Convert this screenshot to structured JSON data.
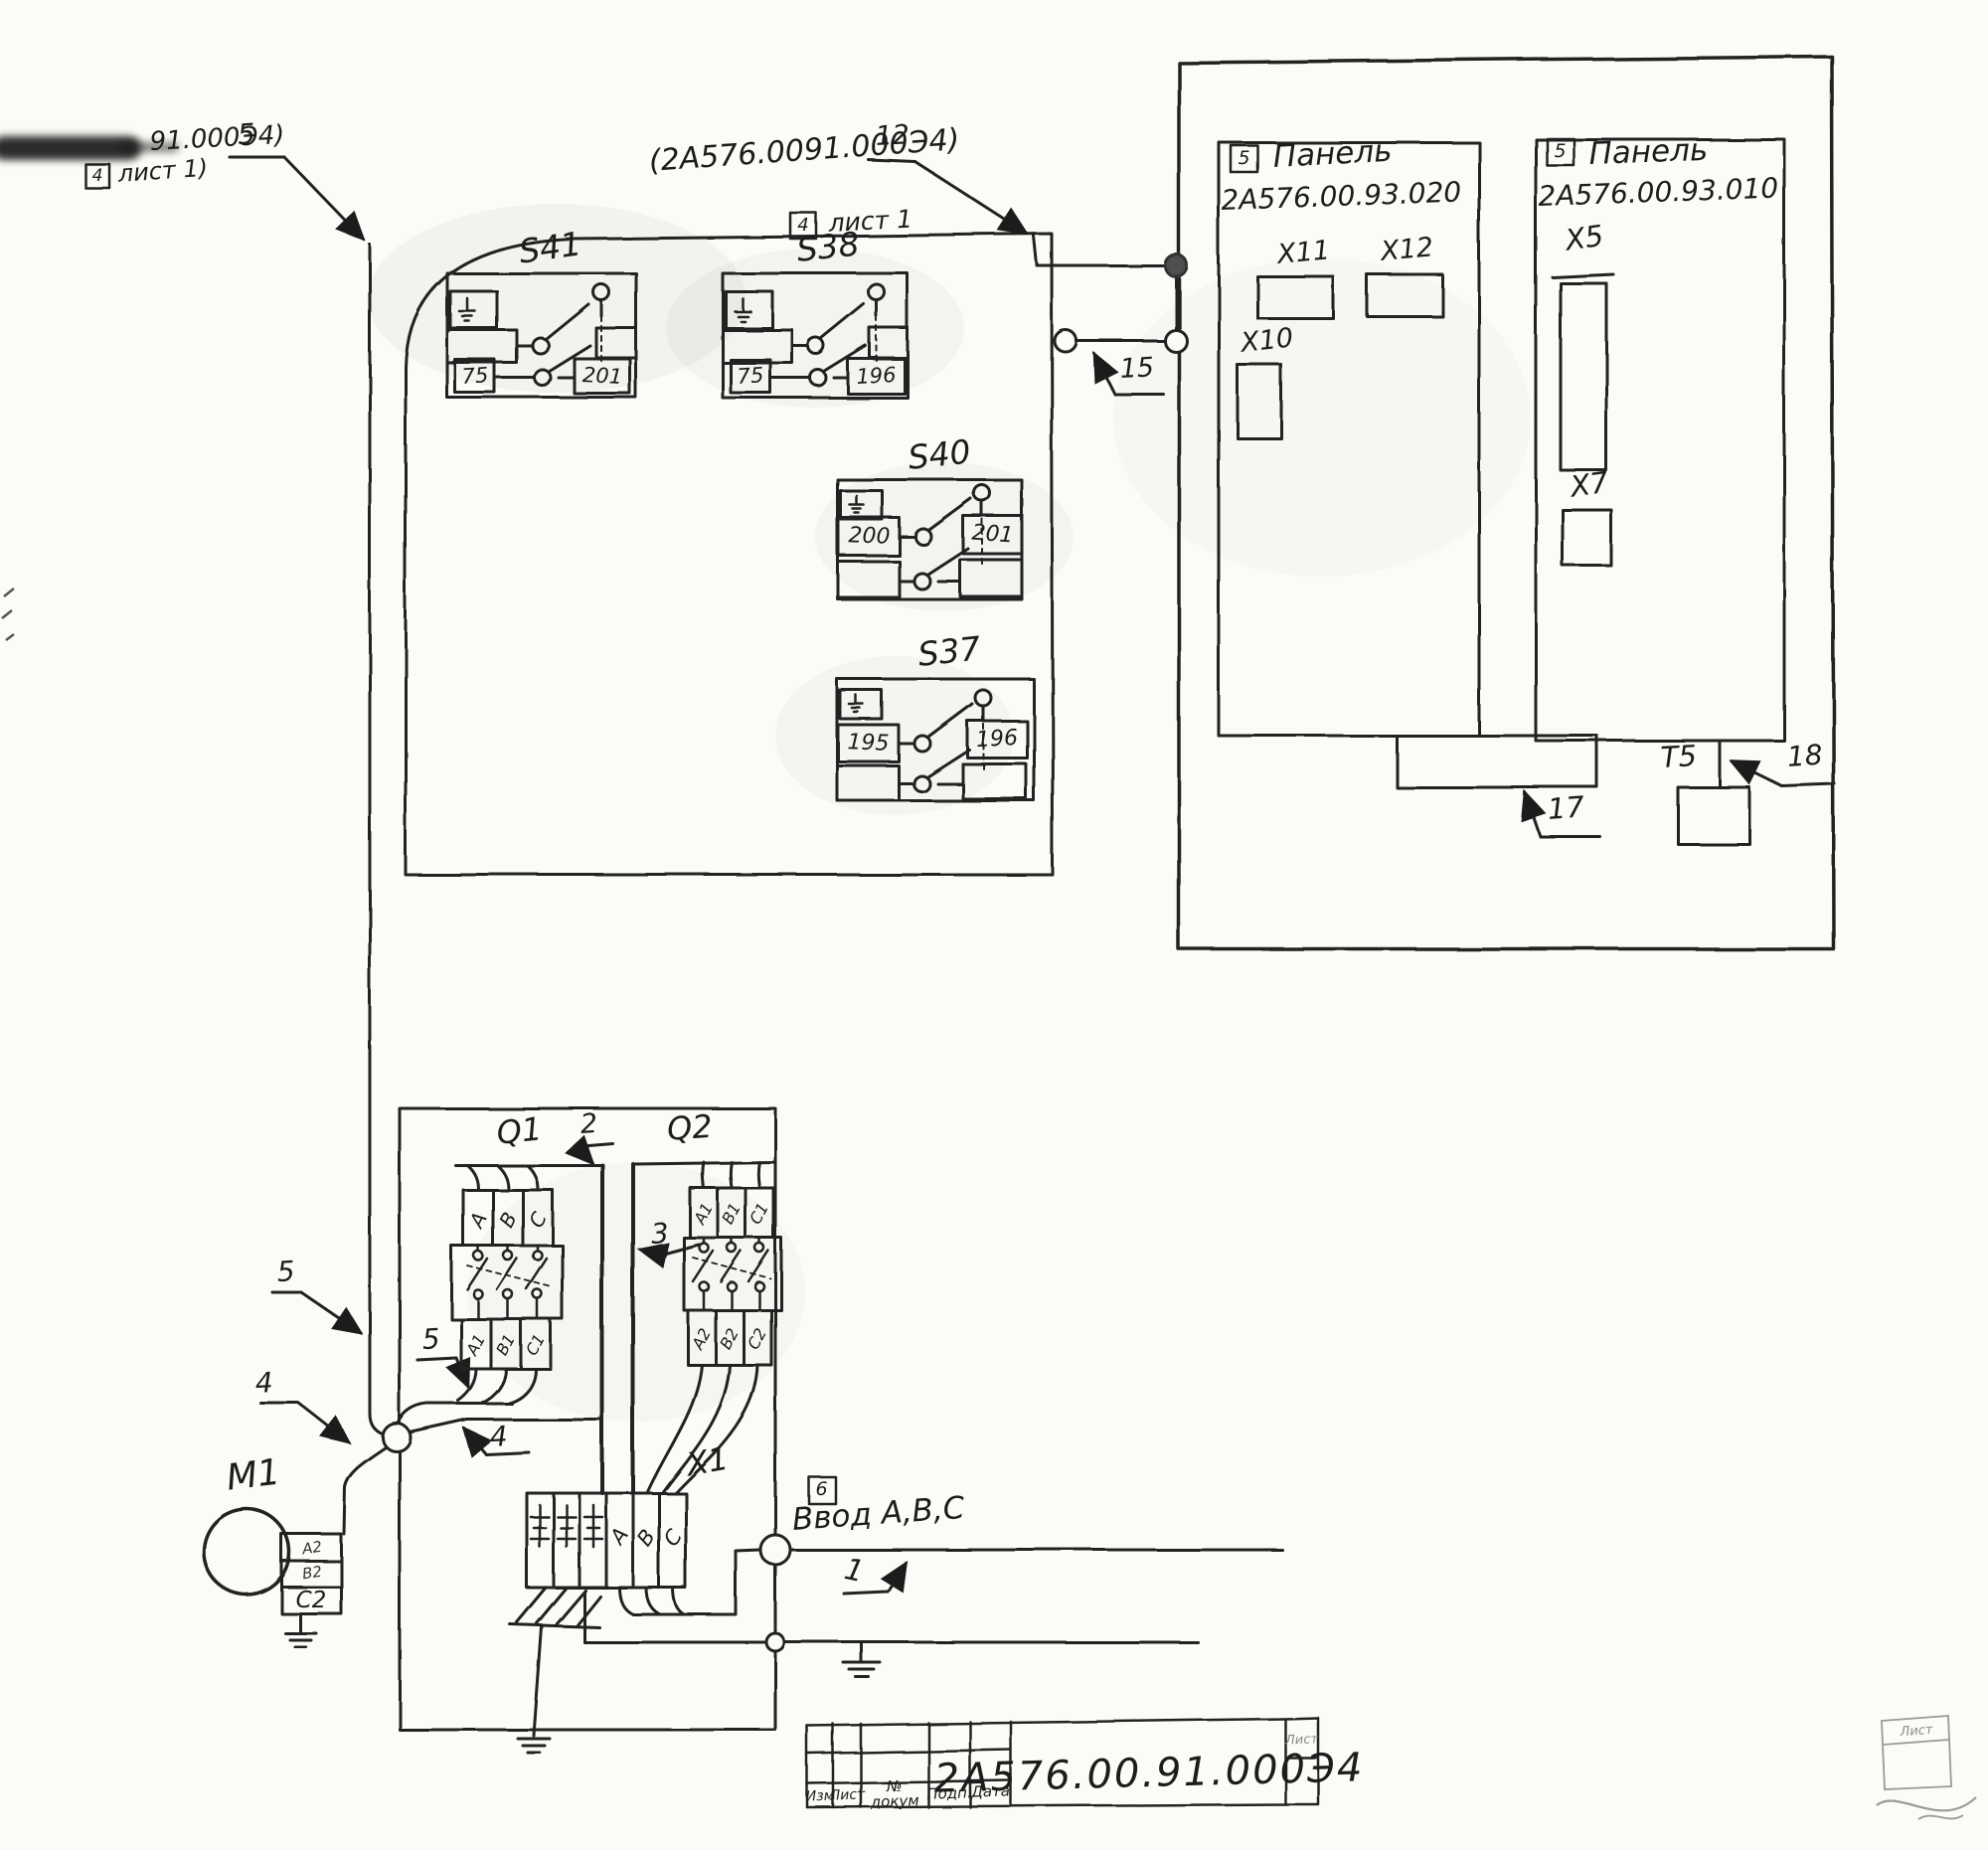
{
  "colors": {
    "ink": "#202020",
    "paper": "#fbfbf7"
  },
  "refs": {
    "top_left": {
      "number": "91.000Э4)",
      "sheet_box": "4",
      "sheet": "лист 1)",
      "cable": "5"
    },
    "top_mid": {
      "number": "(2А576.0091.000Э4)",
      "sheet_box": "4",
      "sheet": "лист 1",
      "cable": "12"
    }
  },
  "switches": [
    {
      "name": "S41",
      "left": "75",
      "right": "201"
    },
    {
      "name": "S38",
      "left": "75",
      "right": "196"
    },
    {
      "name": "S40",
      "left": "200",
      "right": "201"
    },
    {
      "name": "S37",
      "left": "195",
      "right": "196"
    }
  ],
  "panels": [
    {
      "ref": "5",
      "title": "Панель",
      "number": "2А576.00.93.020",
      "x11": "X11",
      "x12": "X12",
      "x10": "X10"
    },
    {
      "ref": "5",
      "title": "Панель",
      "number": "2А576.00.93.010",
      "x5": "X5",
      "x7": "X7"
    }
  ],
  "wire_labels": {
    "t5": "T5",
    "w15": "15",
    "w17": "17",
    "w18": "18",
    "w1": "1",
    "w2": "2",
    "w3": "3",
    "w4a": "4",
    "w4b": "4",
    "w5a": "5",
    "w5b": "5"
  },
  "breakers": {
    "q1": {
      "name": "Q1",
      "top": [
        "А",
        "В",
        "С"
      ],
      "bottom": [
        "А1",
        "В1",
        "С1"
      ]
    },
    "q2": {
      "name": "Q2",
      "top": [
        "А1",
        "В1",
        "С1"
      ],
      "bottom": [
        "А2",
        "В2",
        "С2"
      ]
    }
  },
  "motor": {
    "name": "M1",
    "t1": "А2",
    "t2": "В2",
    "t3": "С2"
  },
  "x1": {
    "name": "X1",
    "a": "А",
    "b": "В",
    "c": "С"
  },
  "input": {
    "ref": "6",
    "label": "Ввод А,В,С",
    "cable": "1"
  },
  "title_block": {
    "col1": "Изм",
    "col2": "Лист",
    "col3": "№ докум",
    "col4": "Подп.",
    "col5": "Дата",
    "number": "2А576.00.91.000Э4",
    "sheet": "Лист",
    "corner_sheet": "Лист"
  }
}
